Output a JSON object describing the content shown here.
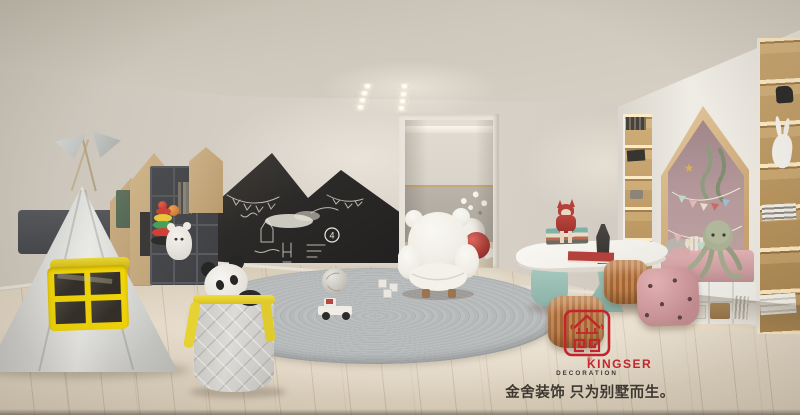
{
  "image": {
    "width": 800,
    "height": 415,
    "kind": "photorealistic interior design render",
    "room_type": "children's playroom in a villa basement"
  },
  "watermark": {
    "brand": "KINGSER",
    "division": "DECORATION",
    "registered_mark": "®",
    "tagline": "金舍装饰 只为别墅而生。",
    "brand_color": "#c4242b",
    "division_color": "#3b3835",
    "tagline_color": "#3e3831"
  },
  "chalkboard": {
    "chalk_number": "4",
    "shape": "double mountain peaks",
    "surface_color": "#2e2c2a",
    "doodles": [
      "bunting garland",
      "chalk smudge cloud",
      "circled number",
      "scribbled drawings"
    ]
  },
  "icons": {
    "star_ornament": "★"
  },
  "palette": {
    "wall": "#d4cdc3",
    "ceiling": "#cfc8bc",
    "floor_wood": "#dccfbb",
    "rug_gray": "#b5b8b9",
    "tent_gray": "#d5d5d2",
    "accent_yellow": "#f0d408",
    "nook_pink_wall": "#b5999b",
    "daybed_pink": "#d6a5a7",
    "stool_cognac": "#b4763f",
    "pouf_pink": "#d4a0a3",
    "table_leg_mint": "#9fc3ba",
    "shelf_wood": "#c9a873",
    "dark_shelf": "#46484b",
    "logo_red": "#c4242b"
  },
  "objects": {
    "tent": "grey teepee play tent with yellow four-pane window and pennant flags",
    "chalkboard": "mountain-shaped blackboard wall with chalk drawings",
    "rug": "round braided grey rug with knitted ball, toy car and blocks",
    "basket": "quilted laundry basket with yellow trim and panda plush",
    "armchair": "white teddy-bear shaped kids armchair",
    "doorway": "open doorway to adjacent lounge with white chair, plant and red sphere",
    "table": "organic white kids table on mint legs with fox-girl figurine, books and statue",
    "stools": "two ribbed cognac leather stools and a pink polka-dot pouf",
    "nook": "house-shaped reading nook with pink wall, bunting, octopus plush and pink daybed",
    "shelves": "house-shaped toy shelves with stacking rings, ball, plush and books",
    "bookcases": "warm-lit built-in bookshelf columns with books and figurines",
    "ceiling_lights": "two columns of recessed spotlights"
  }
}
